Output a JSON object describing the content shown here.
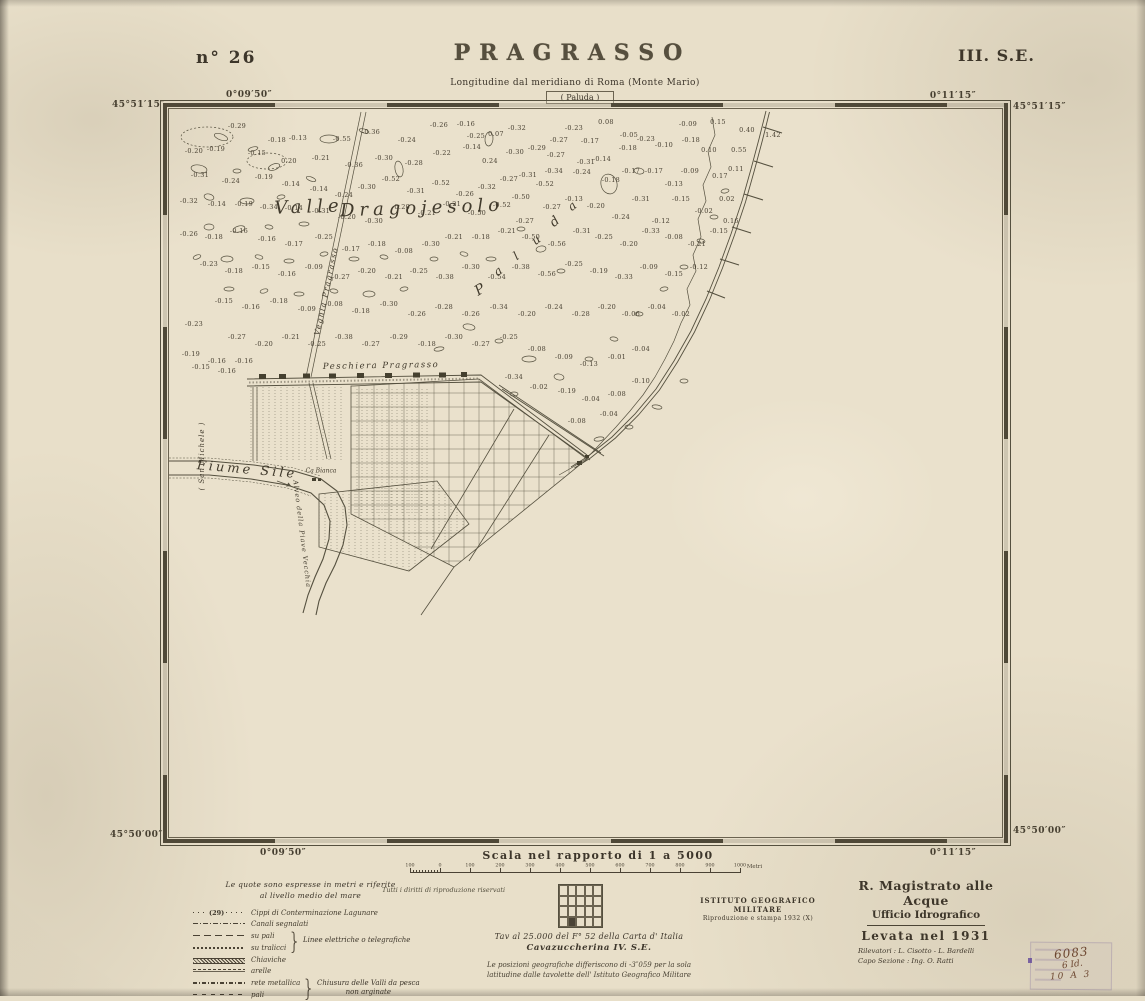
{
  "colors": {
    "paper": "#e8dfc9",
    "ink": "#3c352a",
    "band": "#4f4938",
    "hand_ink": "#6e4630",
    "stamp_purple": "#8a74b0"
  },
  "header": {
    "sheet_number": "n° 26",
    "title": "PRAGRASSO",
    "series_code": "III. S.E.",
    "meridian_note": "Longitudine dal meridiano di Roma (Monte Mario)",
    "adjacent_sheet_north": "( Paluda )"
  },
  "graticule": {
    "top_left_lat": "45°51′15″",
    "top_left_lon": "0°09′50″",
    "top_right_lon": "0°11′15″",
    "top_right_lat": "45°51′15″",
    "bottom_left_lat": "45°50′00″",
    "bottom_left_lon": "0°09′50″",
    "bottom_right_lat": "45°50′00″",
    "bottom_right_lon": "0°11′15″"
  },
  "map": {
    "labels": [
      {
        "t": "Valle",
        "x": 140,
        "y": 98,
        "s": 18,
        "r": -2,
        "ls": 5
      },
      {
        "t": "Dragojesolo",
        "x": 253,
        "y": 99,
        "s": 18,
        "r": -2,
        "ls": 5
      },
      {
        "t": "P",
        "x": 311,
        "y": 181,
        "s": 14,
        "r": -32,
        "ls": 0
      },
      {
        "t": "a",
        "x": 329,
        "y": 162,
        "s": 12,
        "r": -35,
        "ls": 0
      },
      {
        "t": "l",
        "x": 347,
        "y": 147,
        "s": 12,
        "r": -35,
        "ls": 0
      },
      {
        "t": "u",
        "x": 367,
        "y": 131,
        "s": 12,
        "r": -38,
        "ls": 0
      },
      {
        "t": "d",
        "x": 386,
        "y": 113,
        "s": 13,
        "r": -40,
        "ls": 0
      },
      {
        "t": "a",
        "x": 403,
        "y": 97,
        "s": 12,
        "r": -40,
        "ls": 0
      },
      {
        "t": "Vegnia  Pragrasso",
        "x": 157,
        "y": 182,
        "s": 7.5,
        "r": -78,
        "ls": 1.5
      },
      {
        "t": "Peschiera   Pragrasso",
        "x": 212,
        "y": 257,
        "s": 8.5,
        "r": -1,
        "ls": 1.5
      },
      {
        "t": "Fiume  Sile",
        "x": 78,
        "y": 361,
        "s": 13,
        "r": 5,
        "ls": 3
      },
      {
        "t": "Ca Bianca",
        "x": 152,
        "y": 362,
        "s": 6,
        "r": 0,
        "ls": 0
      },
      {
        "t": "Alveo della Piave Vecchia",
        "x": 133,
        "y": 425,
        "s": 6.5,
        "r": 83,
        "ls": 1
      },
      {
        "t": "( San Michele )",
        "x": 33,
        "y": 347,
        "s": 7,
        "r": -90,
        "ls": 1
      }
    ],
    "spot_values": [
      [
        68,
        17,
        "-0.29"
      ],
      [
        108,
        31,
        "-0.18"
      ],
      [
        129,
        29,
        "-0.13"
      ],
      [
        173,
        30,
        "-0.55"
      ],
      [
        202,
        23,
        "-0.36"
      ],
      [
        238,
        31,
        "-0.24"
      ],
      [
        270,
        16,
        "-0.26"
      ],
      [
        297,
        15,
        "-0.16"
      ],
      [
        307,
        27,
        "-0.25"
      ],
      [
        327,
        25,
        "0.07"
      ],
      [
        348,
        19,
        "-0.32"
      ],
      [
        405,
        19,
        "-0.23"
      ],
      [
        437,
        13,
        "0.08"
      ],
      [
        390,
        31,
        "-0.27"
      ],
      [
        421,
        32,
        "-0.17"
      ],
      [
        460,
        26,
        "-0.05"
      ],
      [
        519,
        15,
        "-0.09"
      ],
      [
        549,
        13,
        "0.15"
      ],
      [
        578,
        21,
        "0.40"
      ],
      [
        604,
        26,
        "1.42"
      ],
      [
        25,
        42,
        "-0.20"
      ],
      [
        47,
        40,
        "-0.19"
      ],
      [
        88,
        44,
        "-0.15"
      ],
      [
        120,
        52,
        "0.20"
      ],
      [
        152,
        49,
        "-0.21"
      ],
      [
        185,
        56,
        "-0.36"
      ],
      [
        215,
        49,
        "-0.30"
      ],
      [
        245,
        54,
        "-0.28"
      ],
      [
        273,
        44,
        "-0.22"
      ],
      [
        303,
        38,
        "-0.14"
      ],
      [
        321,
        52,
        "0.24"
      ],
      [
        346,
        43,
        "-0.30"
      ],
      [
        368,
        39,
        "-0.29"
      ],
      [
        387,
        46,
        "-0.27"
      ],
      [
        417,
        53,
        "-0.31"
      ],
      [
        433,
        50,
        "-0.14"
      ],
      [
        459,
        39,
        "-0.18"
      ],
      [
        477,
        30,
        "-0.23"
      ],
      [
        495,
        36,
        "-0.10"
      ],
      [
        522,
        31,
        "-0.18"
      ],
      [
        540,
        41,
        "0.10"
      ],
      [
        570,
        41,
        "0.55"
      ],
      [
        31,
        66,
        "-0.31"
      ],
      [
        62,
        72,
        "-0.24"
      ],
      [
        95,
        68,
        "-0.19"
      ],
      [
        122,
        75,
        "-0.14"
      ],
      [
        150,
        80,
        "-0.14"
      ],
      [
        175,
        86,
        "-0.24"
      ],
      [
        198,
        78,
        "-0.30"
      ],
      [
        222,
        70,
        "-0.52"
      ],
      [
        247,
        82,
        "-0.31"
      ],
      [
        272,
        74,
        "-0.52"
      ],
      [
        296,
        85,
        "-0.26"
      ],
      [
        318,
        78,
        "-0.32"
      ],
      [
        340,
        70,
        "-0.27"
      ],
      [
        359,
        66,
        "-0.31"
      ],
      [
        385,
        62,
        "-0.34"
      ],
      [
        352,
        88,
        "-0.50"
      ],
      [
        376,
        75,
        "-0.52"
      ],
      [
        413,
        63,
        "-0.24"
      ],
      [
        442,
        71,
        "-0.18"
      ],
      [
        462,
        62,
        "-0.17"
      ],
      [
        485,
        62,
        "-0.17"
      ],
      [
        505,
        75,
        "-0.13"
      ],
      [
        521,
        62,
        "-0.09"
      ],
      [
        551,
        67,
        "0.17"
      ],
      [
        567,
        60,
        "0.11"
      ],
      [
        20,
        92,
        "-0.32"
      ],
      [
        48,
        95,
        "-0.14"
      ],
      [
        75,
        95,
        "-0.19"
      ],
      [
        100,
        98,
        "-0.34"
      ],
      [
        125,
        99,
        "-0.14"
      ],
      [
        152,
        102,
        "-0.31"
      ],
      [
        178,
        108,
        "-0.20"
      ],
      [
        205,
        112,
        "-0.30"
      ],
      [
        232,
        98,
        "-0.20"
      ],
      [
        258,
        104,
        "-0.21"
      ],
      [
        283,
        95,
        "-0.21"
      ],
      [
        308,
        104,
        "-0.50"
      ],
      [
        333,
        96,
        "-0.52"
      ],
      [
        356,
        112,
        "-0.27"
      ],
      [
        383,
        98,
        "-0.27"
      ],
      [
        405,
        90,
        "-0.13"
      ],
      [
        427,
        97,
        "-0.20"
      ],
      [
        452,
        108,
        "-0.24"
      ],
      [
        472,
        90,
        "-0.31"
      ],
      [
        492,
        112,
        "-0.12"
      ],
      [
        512,
        90,
        "-0.15"
      ],
      [
        535,
        102,
        "-0.02"
      ],
      [
        558,
        90,
        "0.02"
      ],
      [
        562,
        112,
        "0.16"
      ],
      [
        20,
        125,
        "-0.26"
      ],
      [
        45,
        128,
        "-0.18"
      ],
      [
        70,
        122,
        "-0.16"
      ],
      [
        98,
        130,
        "-0.16"
      ],
      [
        125,
        135,
        "-0.17"
      ],
      [
        155,
        128,
        "-0.25"
      ],
      [
        182,
        140,
        "-0.17"
      ],
      [
        208,
        135,
        "-0.18"
      ],
      [
        235,
        142,
        "-0.08"
      ],
      [
        262,
        135,
        "-0.30"
      ],
      [
        285,
        128,
        "-0.21"
      ],
      [
        312,
        128,
        "-0.18"
      ],
      [
        338,
        122,
        "-0.21"
      ],
      [
        362,
        128,
        "-0.50"
      ],
      [
        388,
        135,
        "-0.56"
      ],
      [
        413,
        122,
        "-0.31"
      ],
      [
        435,
        128,
        "-0.25"
      ],
      [
        460,
        135,
        "-0.20"
      ],
      [
        482,
        122,
        "-0.33"
      ],
      [
        505,
        128,
        "-0.08"
      ],
      [
        528,
        135,
        "-0.21"
      ],
      [
        550,
        122,
        "-0.15"
      ],
      [
        40,
        155,
        "-0.23"
      ],
      [
        65,
        162,
        "-0.18"
      ],
      [
        92,
        158,
        "-0.15"
      ],
      [
        118,
        165,
        "-0.16"
      ],
      [
        145,
        158,
        "-0.09"
      ],
      [
        172,
        168,
        "-0.27"
      ],
      [
        198,
        162,
        "-0.20"
      ],
      [
        225,
        168,
        "-0.21"
      ],
      [
        250,
        162,
        "-0.25"
      ],
      [
        276,
        168,
        "-0.38"
      ],
      [
        302,
        158,
        "-0.30"
      ],
      [
        328,
        168,
        "-0.54"
      ],
      [
        352,
        158,
        "-0.38"
      ],
      [
        378,
        165,
        "-0.56"
      ],
      [
        405,
        155,
        "-0.25"
      ],
      [
        430,
        162,
        "-0.19"
      ],
      [
        455,
        168,
        "-0.33"
      ],
      [
        480,
        158,
        "-0.09"
      ],
      [
        505,
        165,
        "-0.15"
      ],
      [
        530,
        158,
        "-0.12"
      ],
      [
        55,
        192,
        "-0.15"
      ],
      [
        82,
        198,
        "-0.16"
      ],
      [
        110,
        192,
        "-0.18"
      ],
      [
        138,
        200,
        "-0.09"
      ],
      [
        165,
        195,
        "-0.08"
      ],
      [
        192,
        202,
        "-0.18"
      ],
      [
        220,
        195,
        "-0.30"
      ],
      [
        248,
        205,
        "-0.26"
      ],
      [
        275,
        198,
        "-0.28"
      ],
      [
        302,
        205,
        "-0.26"
      ],
      [
        330,
        198,
        "-0.34"
      ],
      [
        358,
        205,
        "-0.20"
      ],
      [
        385,
        198,
        "-0.24"
      ],
      [
        412,
        205,
        "-0.28"
      ],
      [
        438,
        198,
        "-0.20"
      ],
      [
        462,
        205,
        "-0.06"
      ],
      [
        488,
        198,
        "-0.04"
      ],
      [
        512,
        205,
        "-0.02"
      ],
      [
        68,
        228,
        "-0.27"
      ],
      [
        95,
        235,
        "-0.20"
      ],
      [
        122,
        228,
        "-0.21"
      ],
      [
        148,
        235,
        "-0.25"
      ],
      [
        175,
        228,
        "-0.38"
      ],
      [
        202,
        235,
        "-0.27"
      ],
      [
        230,
        228,
        "-0.29"
      ],
      [
        258,
        235,
        "-0.18"
      ],
      [
        285,
        228,
        "-0.30"
      ],
      [
        312,
        235,
        "-0.27"
      ],
      [
        340,
        228,
        "-0.25"
      ],
      [
        368,
        240,
        "-0.08"
      ],
      [
        395,
        248,
        "-0.09"
      ],
      [
        420,
        255,
        "-0.13"
      ],
      [
        448,
        248,
        "-0.01"
      ],
      [
        472,
        240,
        "-0.04"
      ],
      [
        25,
        215,
        "-0.23"
      ],
      [
        22,
        245,
        "-0.19"
      ],
      [
        48,
        252,
        "-0.16"
      ],
      [
        75,
        252,
        "-0.16"
      ],
      [
        32,
        258,
        "-0.15"
      ],
      [
        58,
        262,
        "-0.16"
      ],
      [
        345,
        268,
        "-0.34"
      ],
      [
        370,
        278,
        "-0.02"
      ],
      [
        398,
        282,
        "-0.19"
      ],
      [
        422,
        290,
        "-0.04"
      ],
      [
        448,
        285,
        "-0.08"
      ],
      [
        472,
        272,
        "-0.10"
      ],
      [
        440,
        305,
        "-0.04"
      ],
      [
        408,
        312,
        "-0.08"
      ]
    ]
  },
  "legend": {
    "intro1": "Le quote sono espresse in metri e riferite",
    "intro2": "al livello medio del mare",
    "cippi_number": "(29)",
    "items": [
      {
        "label": "Cippi di Conterminazione Lagunare"
      },
      {
        "label": "Canali segnalati"
      },
      {
        "label": "su pali"
      },
      {
        "label": "su tralicci"
      },
      {
        "label": "Chiaviche"
      },
      {
        "label": "arelle"
      },
      {
        "label": "rete metallica"
      },
      {
        "label": "pali"
      }
    ],
    "group1": "Linee elettriche o telegrafiche",
    "group2a": "Chiusura delle Valli da pesca",
    "group2b": "non arginate"
  },
  "rights_note": "Tutti i diritti di riproduzione riservati",
  "scale": {
    "title": "Scala nel rapporto di 1 a 5000",
    "ticks": [
      "100",
      "0",
      "100",
      "200",
      "300",
      "400",
      "500",
      "600",
      "700",
      "800",
      "900",
      "1000"
    ],
    "unit": "Metri"
  },
  "footer": {
    "index_grid": {
      "cols": 5,
      "rows": 4,
      "filled_row": 3,
      "filled_col": 1
    },
    "caption1": "Tav al 25.000 del F° 52 della Carta d' Italia",
    "caption2": "Cavazuccherina   IV. S.E.",
    "note1": "Le posizioni geografiche differiscono di -3″059 per la sola",
    "note2": "latitudine dalle tavolette dell' Istituto Geografico Militare",
    "igm1": "ISTITUTO GEOGRAFICO MILITARE",
    "igm2": "Riproduzione e stampa 1932 (X)",
    "agency1": "R. Magistrato alle Acque",
    "agency2": "Ufficio Idrografico",
    "survey": "Levata nel 1931",
    "surveyors": "Rilevatori : L. Cisotto - L. Bardelli",
    "chief": "Capo Sezione :  Ing. O. Ratti"
  },
  "stamp": {
    "line1": "6083",
    "line2": "6 Id.",
    "line3": "10 A 3"
  }
}
